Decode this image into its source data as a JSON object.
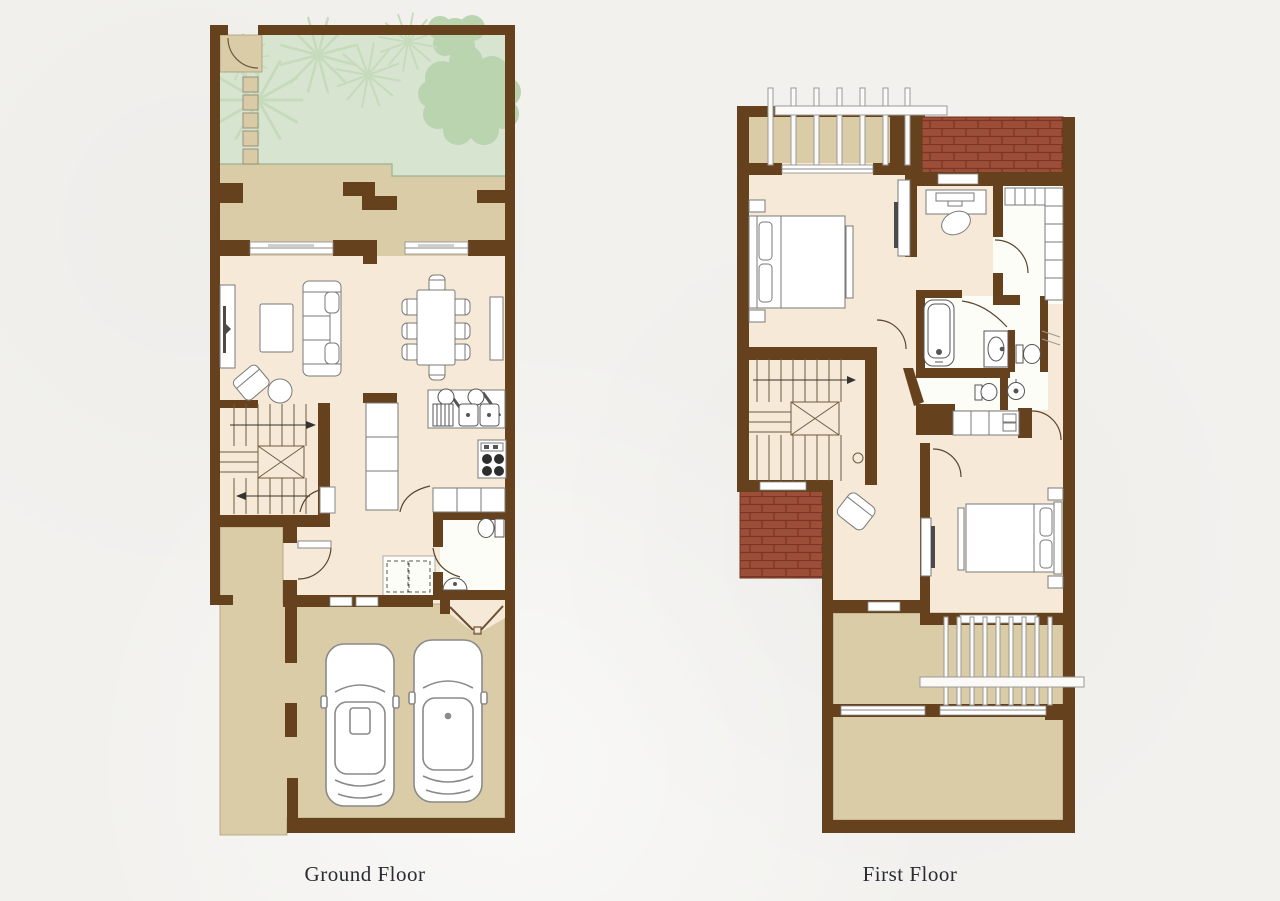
{
  "page": {
    "background": "#f2f1ee"
  },
  "palette": {
    "wall_brown": "#66411d",
    "interior_cream": "#f6e9d7",
    "terrace_tan": "#d9cca6",
    "garden_green": "#d6e4d0",
    "tree_green": "#b9d4ae",
    "palm_green": "#c6dbbc",
    "brick_red": "#9d4e38",
    "bath_white": "#fdfdf8",
    "label_text": "#2b2b33"
  },
  "floors": [
    {
      "id": "ground-floor",
      "label": "Ground Floor",
      "features": [
        "entry-gate",
        "garden",
        "palm-trees",
        "shade-tree",
        "stepping-stones",
        "rear-terrace",
        "living-room",
        "dining-area",
        "kitchen",
        "staircase",
        "entry-hall",
        "laundry-closet",
        "powder-room",
        "entrance-porch",
        "carport",
        "parked-cars"
      ]
    },
    {
      "id": "first-floor",
      "label": "First Floor",
      "features": [
        "pergola-balcony",
        "tiled-roof",
        "master-bedroom",
        "study-desk",
        "walk-in-closet",
        "bathroom",
        "guest-wc",
        "staircase",
        "sitting-area",
        "bedroom-two",
        "pergola-terrace",
        "roof-terrace"
      ]
    }
  ]
}
